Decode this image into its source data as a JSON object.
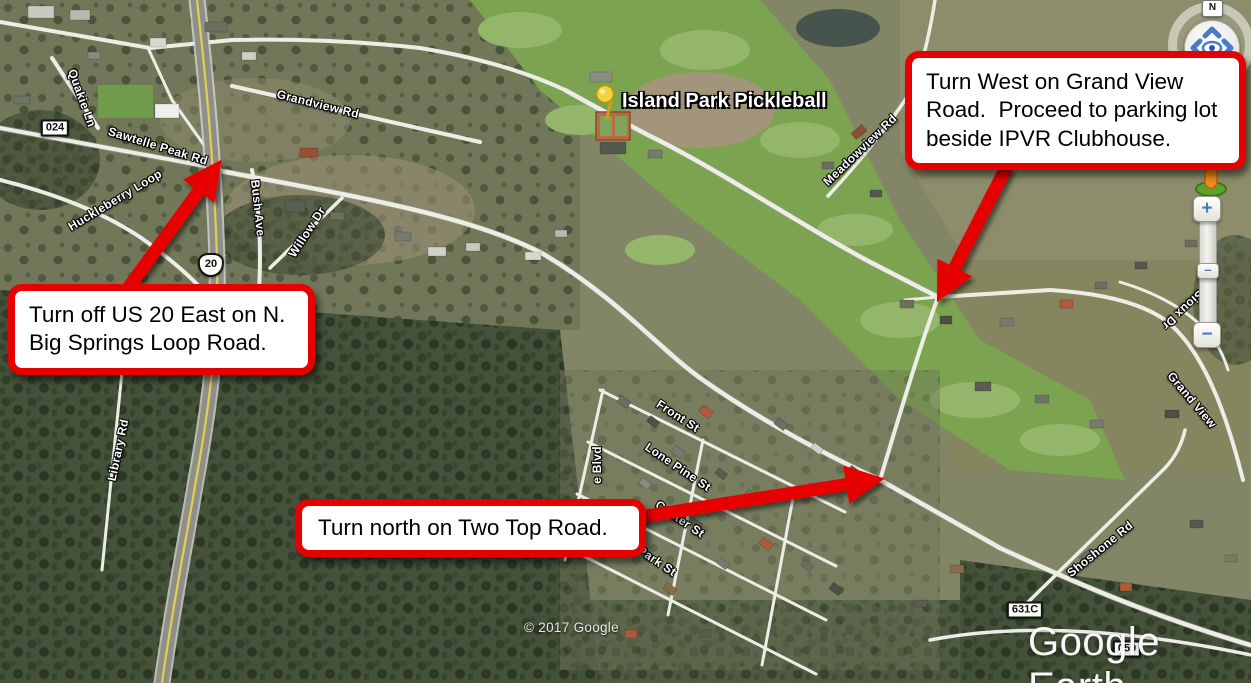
{
  "callouts": {
    "grand_view": "Turn West on Grand View Road.  Proceed to parking lot beside IPVR Clubhouse.",
    "us20": "Turn off US 20 East on N. Big Springs Loop Road.",
    "two_top": "Turn north on Two Top Road."
  },
  "map": {
    "place_label": "Island Park Pickleball",
    "attribution": "© 2017 Google",
    "logo": "Google Earth",
    "road_labels": [
      {
        "id": "quakie-ln",
        "text": "Quakie Ln"
      },
      {
        "id": "sawtelle-peak-rd",
        "text": "Sawtelle Peak Rd"
      },
      {
        "id": "huckleberry-loop",
        "text": "Huckleberry Loop"
      },
      {
        "id": "library-rd",
        "text": "Library Rd"
      },
      {
        "id": "bush-ave",
        "text": "Bush Ave"
      },
      {
        "id": "willow-dr",
        "text": "Willow Dr"
      },
      {
        "id": "grandview-rd",
        "text": "Grandview Rd"
      },
      {
        "id": "meadowview-rd",
        "text": "Meadowview Rd"
      },
      {
        "id": "front-st",
        "text": "Front St"
      },
      {
        "id": "lone-pine-st",
        "text": "Lone Pine St"
      },
      {
        "id": "center-st",
        "text": "Center St"
      },
      {
        "id": "park-st",
        "text": "Park St"
      },
      {
        "id": "e-blvd",
        "text": "e Blvd"
      },
      {
        "id": "sioux-dr",
        "text": "Sioux Dr"
      },
      {
        "id": "grand-view",
        "text": "Grand View"
      },
      {
        "id": "shoshone-rd",
        "text": "Shoshone Rd"
      }
    ],
    "shields": [
      {
        "id": "024",
        "text": "024"
      },
      {
        "id": "us-20",
        "text": "20"
      },
      {
        "id": "631c",
        "text": "631C"
      },
      {
        "id": "059",
        "text": "059"
      }
    ]
  },
  "controls": {
    "compass_north": "N",
    "zoom_in": "+",
    "zoom_out": "−",
    "zoom_handle": "–"
  },
  "colors": {
    "callout_red": "#e60000",
    "arrow_red": "#e60000",
    "road_white": "#ececе4",
    "highway_yellow": "#e3cf4b",
    "golf_green": "#7ba350",
    "forest_green": "#3f4936",
    "control_blue": "#4a78b8"
  }
}
